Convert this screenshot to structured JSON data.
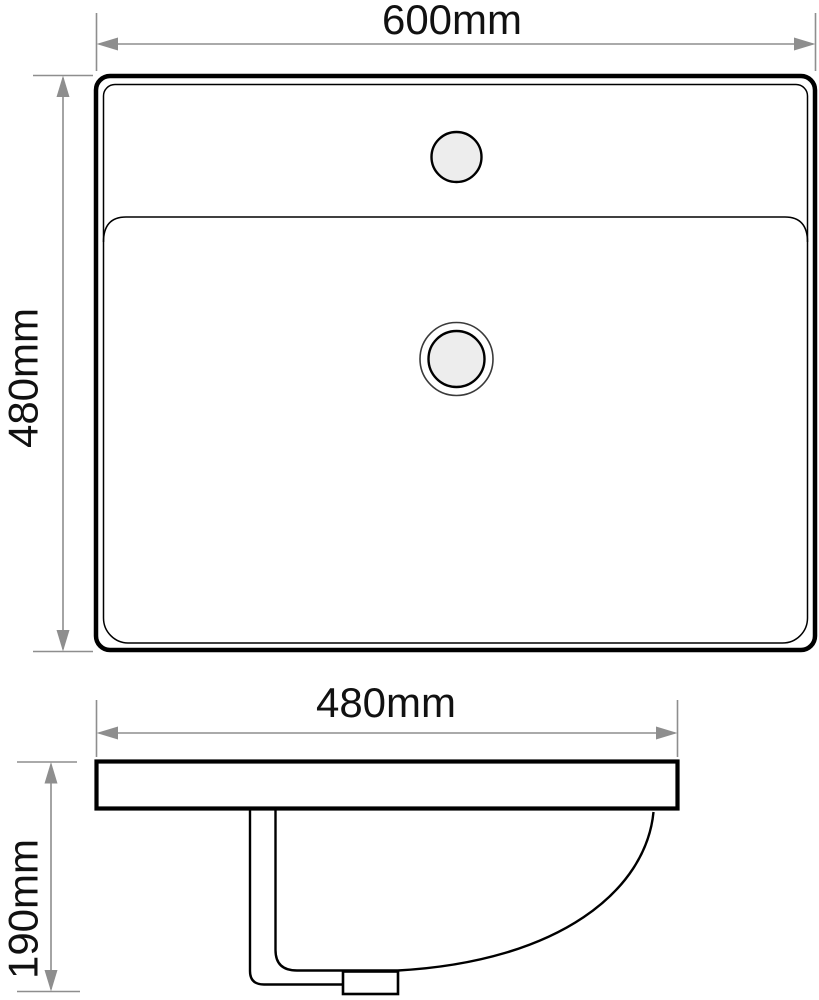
{
  "dimensions": {
    "overall_width": "600mm",
    "overall_depth": "480mm",
    "bowl_width": "480mm",
    "height": "190mm"
  },
  "colors": {
    "outline": "#000000",
    "dimension_lines": "#8e8e8e",
    "label_text": "#111111",
    "hole_fill": "#ededed",
    "background": "#ffffff"
  }
}
